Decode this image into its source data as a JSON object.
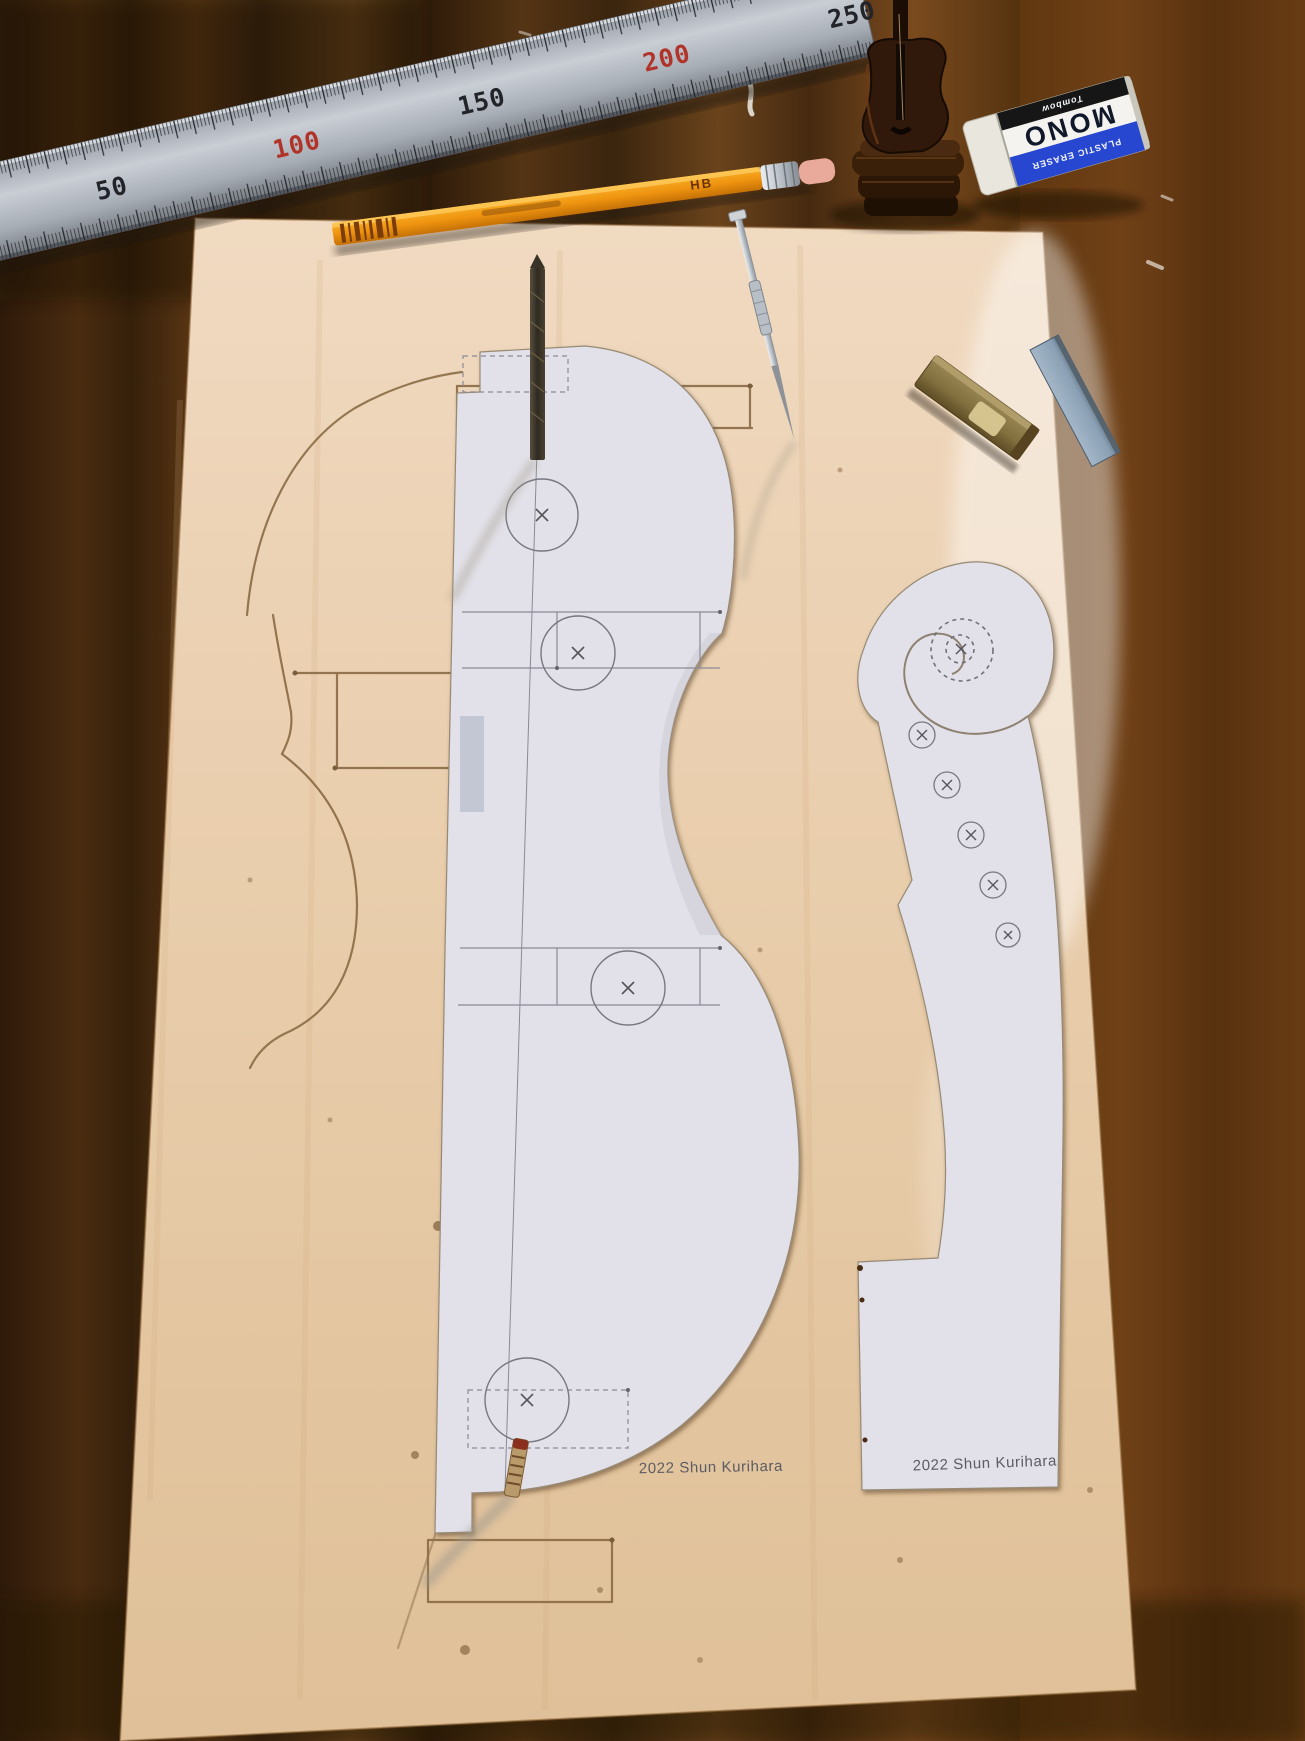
{
  "scene": {
    "description": "Violin making workbench photo: half-body violin template and scroll template papers glued to a plywood board on a dark wooden table, with steel ruler, pencil, awl, drill bit, marking peg, miniature violin figurine, MONO eraser and machinist square",
    "items": {
      "table": "dark wooden table",
      "board": "plywood board",
      "body_template": "violin half-body paper template",
      "scroll_template": "violin scroll and neck paper template",
      "traced_outline": "pencil-traced violin outline on wood",
      "ruler": "steel ruler",
      "pencil": "orange pencil",
      "awl": "metal awl",
      "drill_bit": "drill bit standing in template",
      "peg": "marking peg",
      "figurine": "miniature violin figurine",
      "eraser": "MONO plastic eraser",
      "square": "small machinist square"
    }
  },
  "ruler": {
    "marks": [
      {
        "label": "50",
        "color": "#23242a"
      },
      {
        "label": "100",
        "color": "#b0342a"
      },
      {
        "label": "150",
        "color": "#23242a"
      },
      {
        "label": "200",
        "color": "#b0342a"
      },
      {
        "label": "250",
        "color": "#23242a"
      }
    ]
  },
  "pencil": {
    "grade_label": "HB"
  },
  "eraser": {
    "brand": "Tombow",
    "product": "MONO",
    "subtitle": "PLASTIC ERASER"
  },
  "templates": {
    "body_signature": "2022 Shun Kurihara",
    "scroll_signature": "2022 Shun Kurihara"
  },
  "colors": {
    "table_wood": "#4a2c10",
    "board": "#e9cfae",
    "paper": "#e2e1e9",
    "eraser_blue": "#2847d0",
    "pencil_orange": "#ef9410",
    "brass": "#8e7b4b",
    "blade_blue": "#8ba0b4"
  }
}
